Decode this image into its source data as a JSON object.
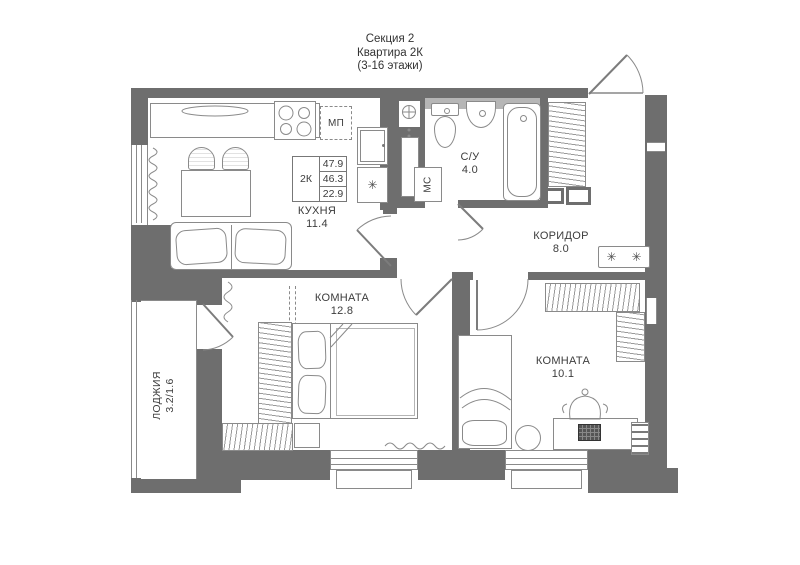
{
  "title": {
    "line1": "Секция 2",
    "line2": "Квартира 2К",
    "line3": "(3-16 этажи)"
  },
  "info_table": {
    "unit": "2К",
    "rows": [
      "47.9",
      "46.3",
      "22.9"
    ]
  },
  "rooms": {
    "kitchen": {
      "name": "КУХНЯ",
      "area": "11.4"
    },
    "bedroom_main": {
      "name": "КОМНАТА",
      "area": "12.8"
    },
    "bedroom_second": {
      "name": "КОМНАТА",
      "area": "10.1"
    },
    "corridor": {
      "name": "КОРИДОР",
      "area": "8.0"
    },
    "bathroom": {
      "name": "С/У",
      "area": "4.0"
    },
    "loggia": {
      "name": "ЛОДЖИЯ",
      "area": "3.2/1.6"
    }
  },
  "appliance_labels": {
    "dishwasher_slot": "МП",
    "washer_slot": "МС",
    "fridge_symbol": "✳",
    "console_symbol_left": "✳",
    "console_symbol_right": "✳"
  },
  "colors": {
    "wall": "#6e6e6e",
    "line": "#8a8a8a",
    "text": "#3c3c3c",
    "band": "#b6b6b6",
    "bg": "#ffffff"
  }
}
